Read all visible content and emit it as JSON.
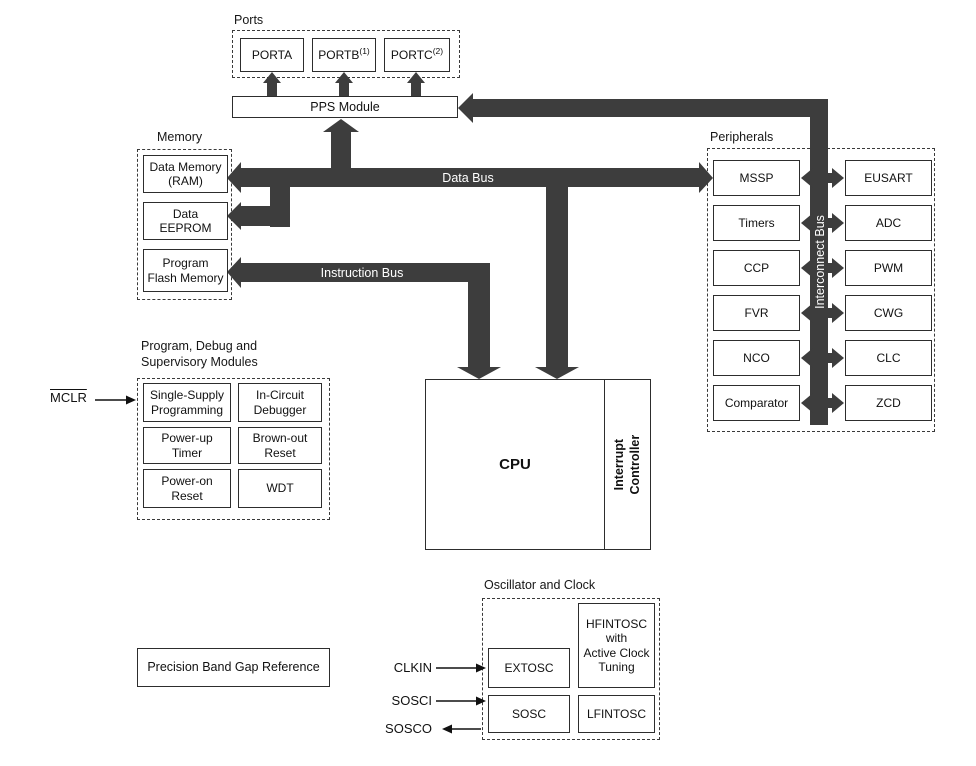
{
  "colors": {
    "bus": "#3d3d3d",
    "box_border": "#2d2d2d",
    "background": "#ffffff",
    "bus_text": "#ffffff"
  },
  "ports": {
    "group_label": "Ports",
    "items": [
      {
        "name": "PORTA",
        "note": ""
      },
      {
        "name": "PORTB",
        "note": "(1)"
      },
      {
        "name": "PORTC",
        "note": "(2)"
      }
    ],
    "pps_label": "PPS Module"
  },
  "memory": {
    "group_label": "Memory",
    "ram": "Data Memory\n(RAM)",
    "eeprom": "Data\nEEPROM",
    "flash": "Program\nFlash Memory"
  },
  "buses": {
    "data": "Data Bus",
    "instruction": "Instruction Bus",
    "interconnect": "Interconnect Bus"
  },
  "cpu": {
    "label": "CPU",
    "interrupt_controller": "Interrupt\nController"
  },
  "peripherals": {
    "group_label": "Peripherals",
    "left": [
      "MSSP",
      "Timers",
      "CCP",
      "FVR",
      "NCO",
      "Comparator"
    ],
    "right": [
      "EUSART",
      "ADC",
      "PWM",
      "CWG",
      "CLC",
      "ZCD"
    ]
  },
  "debug": {
    "group_label": "Program, Debug and\nSupervisory Modules",
    "boxes": [
      "Single-Supply\nProgramming",
      "In-Circuit\nDebugger",
      "Power-up\nTimer",
      "Brown-out\nReset",
      "Power-on\nReset",
      "WDT"
    ]
  },
  "signals": {
    "mclr": "MCLR",
    "clkin": "CLKIN",
    "sosci": "SOSCI",
    "sosco": "SOSCO"
  },
  "oscillator": {
    "group_label": "Oscillator and Clock",
    "extosc": "EXTOSC",
    "hfintosc": "HFINTOSC\nwith\nActive Clock\nTuning",
    "sosc": "SOSC",
    "lfintosc": "LFINTOSC"
  },
  "bandgap": "Precision Band Gap Reference"
}
